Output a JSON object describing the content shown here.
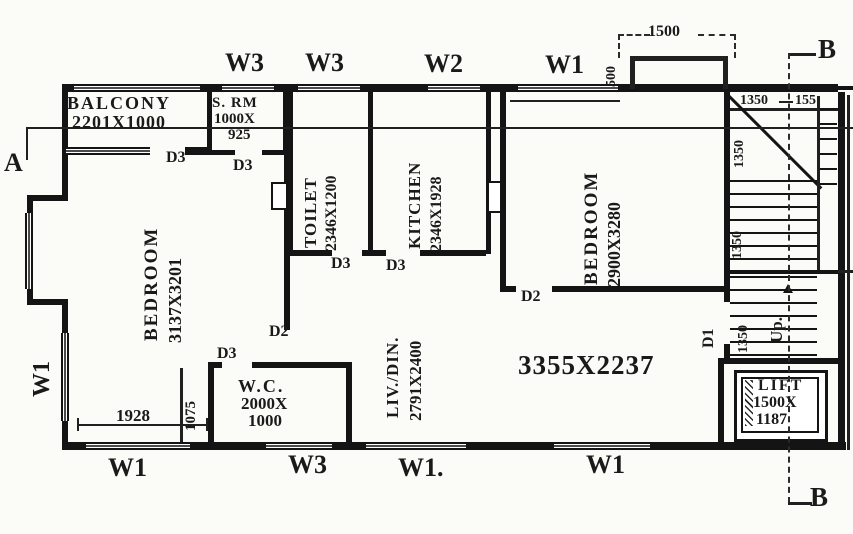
{
  "sections": {
    "a": "A",
    "b_top": "B",
    "b_bottom": "B"
  },
  "rooms": {
    "balcony": {
      "name": "BALCONY",
      "dim": "2201X1000"
    },
    "srm": {
      "name": "S. RM",
      "dim1": "1000X",
      "dim2": "925"
    },
    "toilet": {
      "name": "TOILET",
      "dim": "2346X1200"
    },
    "kitchen": {
      "name": "KITCHEN",
      "dim": "2346X1928"
    },
    "bedroom_right": {
      "name": "BEDROOM",
      "dim": "2900X3280"
    },
    "bedroom_left": {
      "name": "BEDROOM",
      "dim": "3137X3201"
    },
    "livdin": {
      "name": "LIV./DIN.",
      "dim": "2791X2400"
    },
    "wc": {
      "name": "W.C.",
      "dim1": "2000X",
      "dim2": "1000"
    },
    "hall": {
      "dim": "3355X2237"
    },
    "lift": {
      "name": "LIFT",
      "dim1": "1500X",
      "dim2": "1187"
    }
  },
  "window_tags": {
    "w3_srm": "W3",
    "w3_toilet": "W3",
    "w2_kitchen": "W2",
    "w1_bedroom": "W1",
    "w1_left": "W1",
    "w1_bottom_a": "W1",
    "w3_bottom": "W3",
    "w1_bottom_b": "W1.",
    "w1_bottom_c": "W1"
  },
  "door_tags": {
    "d3_balcony": "D3",
    "d3_srm": "D3",
    "d3_toilet": "D3",
    "d3_kitchen": "D3",
    "d3_wc": "D3",
    "d2_livdin": "D2",
    "d2_bedroom": "D2",
    "d1_stair": "D1"
  },
  "dims": {
    "t1500": "1500",
    "t500": "500",
    "s1350h": "1350",
    "s155": "155",
    "s1350v1": "1350",
    "s1350v2": "1350",
    "s1350v3": "1350",
    "w1075": "1075",
    "w1928": "1928"
  },
  "stairs": {
    "up": "Up."
  },
  "ink_color": "#1a1a1a",
  "paper_color": "#fbfbf8"
}
